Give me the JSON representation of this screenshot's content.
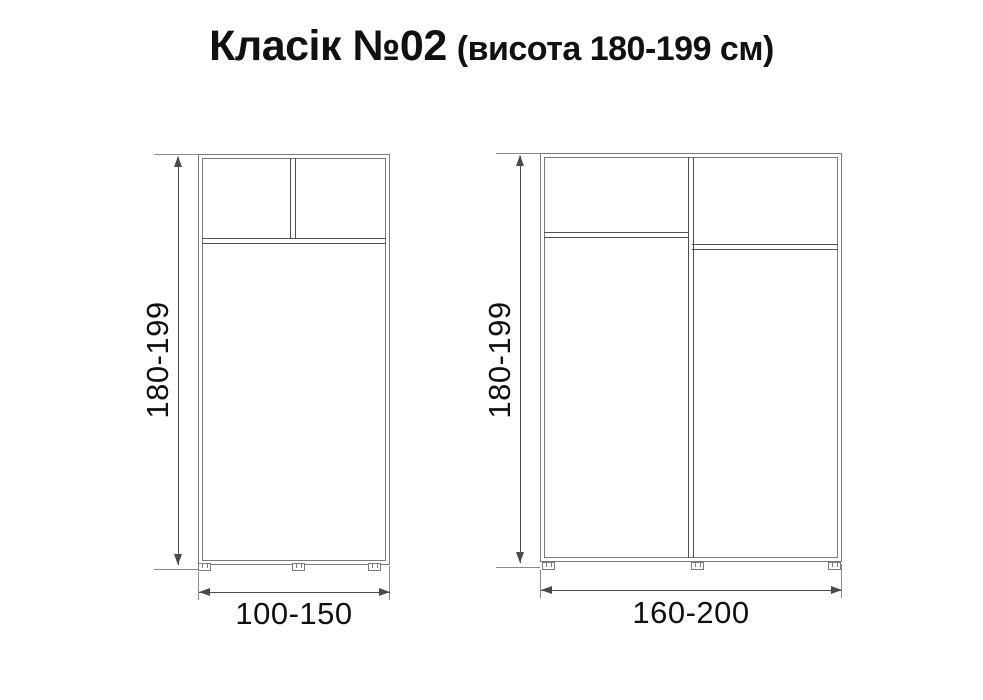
{
  "title": {
    "main": "Класік №02",
    "suffix": "(висота 180-199 см)"
  },
  "diagrams": {
    "left": {
      "description": "two-section wardrobe with two top compartments",
      "height_label": "180-199",
      "width_label": "100-150"
    },
    "right": {
      "description": "two-door wardrobe with full-height divider and offset shelves",
      "height_label": "180-199",
      "width_label": "160-200"
    }
  },
  "colors": {
    "frame": "#7a7a7a",
    "detail": "#4f4f4f",
    "dimension": "#4a4a4a",
    "text": "#111111"
  }
}
